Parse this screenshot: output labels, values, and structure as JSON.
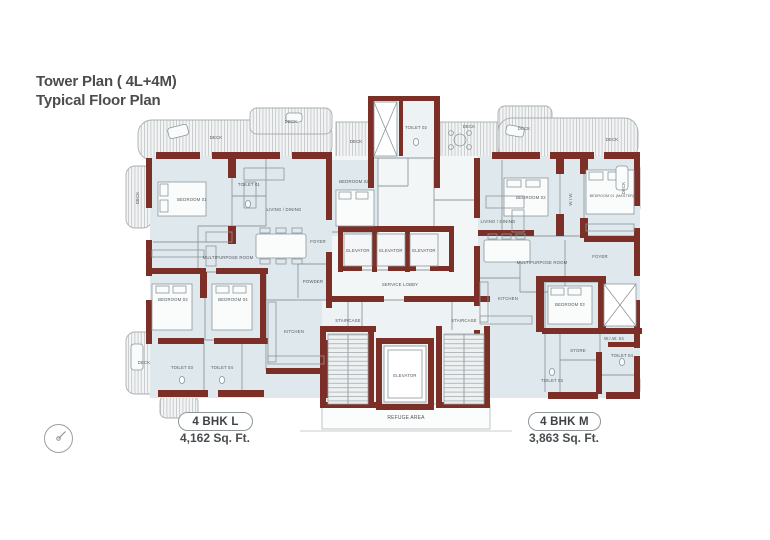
{
  "title": {
    "line1": "Tower Plan ( 4L+4M)",
    "line2": "Typical Floor Plan"
  },
  "units": {
    "left": {
      "name": "4 BHK L",
      "area": "4,162 Sq. Ft."
    },
    "right": {
      "name": "4 BHK M",
      "area": "3,863 Sq. Ft."
    }
  },
  "colors": {
    "wall": "#7b2f26",
    "floor": "#dfe9ed",
    "floor2": "#edf2f4",
    "corefloor": "#f3f6f7",
    "line": "#8f999e",
    "text": "#53595d",
    "title": "#4b4c4e",
    "pill": "#8f969a"
  },
  "labels": {
    "deck": "Deck",
    "bedroom01": "Bedroom 01",
    "bedroom02": "Bedroom 02",
    "bedroom03": "Bedroom 03",
    "bedroom04": "Bedroom 04",
    "master": "Bedroom 01 (Master)",
    "toilet01": "Toilet 01",
    "toilet02": "Toilet 02",
    "toilet03": "Toilet 03",
    "toilet04": "Toilet 04",
    "living": "Living / Dining",
    "multipurpose": "Multipurpose Room",
    "kitchen": "Kitchen",
    "powder": "Powder",
    "foyer": "Foyer",
    "wiw": "W.I.W.",
    "wiw04": "W.I.W. 04",
    "store": "Store",
    "elevator": "Elevator",
    "serviceLobby": "Service Lobby",
    "staircase": "Staircase",
    "refuge": "Refuge Area"
  }
}
